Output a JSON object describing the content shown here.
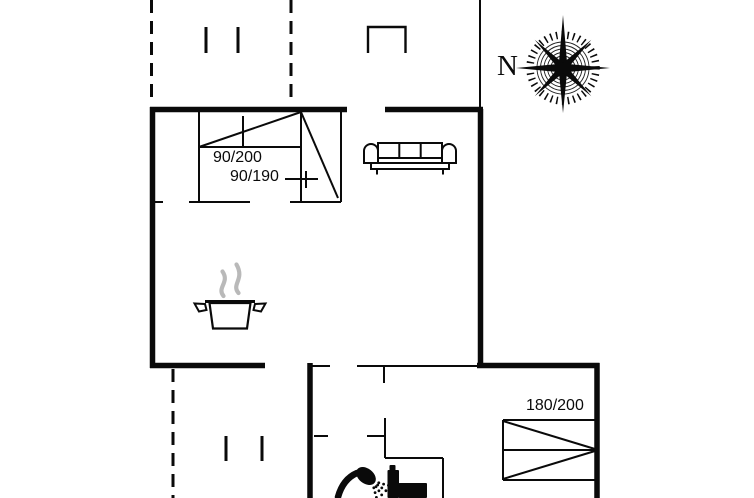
{
  "plan": {
    "type": "floor-plan",
    "background": "#ffffff",
    "wall_color": "#0a0a0a",
    "steam_color": "#b9b9b9"
  },
  "compass": {
    "north_label": "N",
    "icon": "compass-rose-icon"
  },
  "labels": {
    "bed_a": "90/200",
    "bed_b": "90/190",
    "double_bed": "180/200"
  },
  "icons": [
    "compass-rose-icon",
    "single-bed-icon",
    "bunk-bed-icon",
    "double-bed-icon",
    "sofa-icon",
    "cooking-pot-icon",
    "steam-icon",
    "shower-icon",
    "toilet-icon"
  ]
}
